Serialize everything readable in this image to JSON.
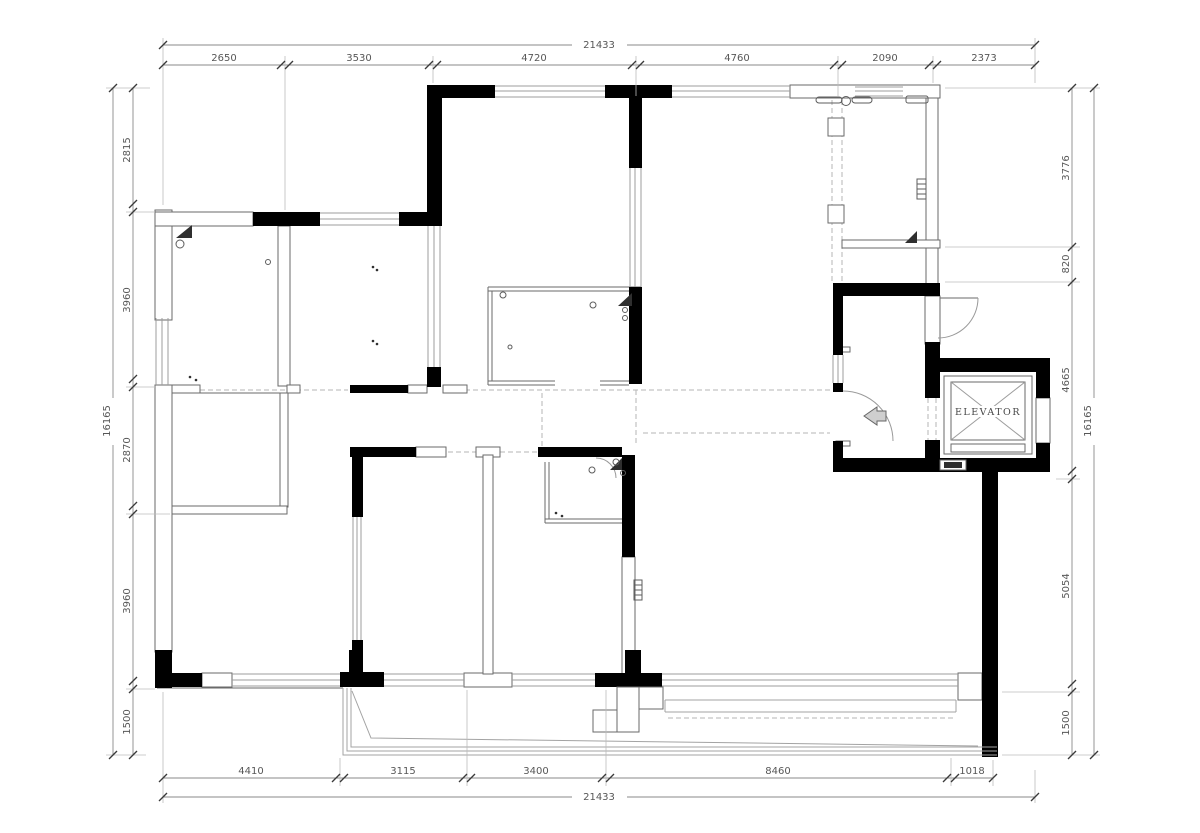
{
  "plan": {
    "elevator_label": "ELEVATOR",
    "dims": {
      "top": {
        "overall": "21433",
        "segments": [
          "2650",
          "3530",
          "4720",
          "4760",
          "2090",
          "2373"
        ]
      },
      "bottom": {
        "overall": "21433",
        "segments": [
          "4410",
          "3115",
          "3400",
          "8460",
          "1018"
        ]
      },
      "left": {
        "overall": "16165",
        "segments": [
          "2815",
          "3960",
          "2870",
          "3960",
          "1500"
        ]
      },
      "right": {
        "overall": "16165",
        "segments": [
          "3776",
          "820",
          "4665",
          "5054",
          "1500"
        ]
      }
    },
    "colors": {
      "wall": "#000000",
      "thin_line": "#6a6a6a",
      "window_line": "#9c9c9c",
      "dim_text": "#575757",
      "background": "#ffffff"
    }
  }
}
